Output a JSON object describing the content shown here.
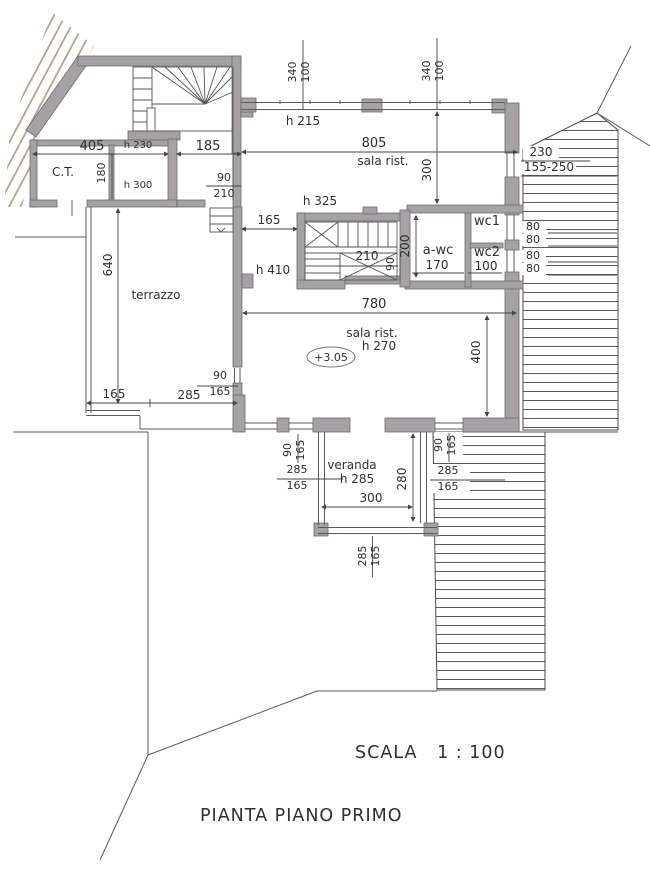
{
  "drawing": {
    "title": "PIANTA PIANO PRIMO",
    "scale_label": "SCALA   1 : 100"
  },
  "colors": {
    "wall": "#a5a1a5",
    "wall_stroke": "#6e6a6e",
    "line": "#4a4a4a",
    "terrain_hatch": "#ab9a7d",
    "text": "#2f2f2f",
    "background": "#ffffff"
  },
  "annotations": [
    {
      "name": "dim-340-left",
      "text": "340",
      "x": 296,
      "y": 72,
      "fs": 11,
      "r": -90
    },
    {
      "name": "dim-100-left",
      "text": "100",
      "x": 309,
      "y": 72,
      "fs": 11,
      "r": -90
    },
    {
      "name": "dim-340-right",
      "text": "340",
      "x": 430,
      "y": 71,
      "fs": 11,
      "r": -90
    },
    {
      "name": "dim-100-right",
      "text": "100",
      "x": 443,
      "y": 71,
      "fs": 11,
      "r": -90
    },
    {
      "name": "height-h215",
      "text": "h 215",
      "x": 303,
      "y": 125,
      "fs": 12
    },
    {
      "name": "dim-805",
      "text": "805",
      "x": 374,
      "y": 147,
      "fs": 13
    },
    {
      "name": "room-sala-rist-north",
      "text": "sala rist.",
      "x": 383,
      "y": 165,
      "fs": 12
    },
    {
      "name": "dim-300-vert",
      "text": "300",
      "x": 431,
      "y": 170,
      "fs": 12,
      "r": -90
    },
    {
      "name": "dim-230",
      "text": "230",
      "x": 541,
      "y": 156,
      "fs": 12
    },
    {
      "name": "dim-155-250",
      "text": "155-250",
      "x": 549,
      "y": 171,
      "fs": 12
    },
    {
      "name": "dim-405",
      "text": "405",
      "x": 92,
      "y": 150,
      "fs": 13
    },
    {
      "name": "height-h230",
      "text": "h 230",
      "x": 138,
      "y": 148,
      "fs": 10
    },
    {
      "name": "dim-185",
      "text": "185",
      "x": 208,
      "y": 150,
      "fs": 13
    },
    {
      "name": "room-ct",
      "text": "C.T.",
      "x": 63,
      "y": 176,
      "fs": 12
    },
    {
      "name": "dim-180",
      "text": "180",
      "x": 105,
      "y": 173,
      "fs": 11,
      "r": -90
    },
    {
      "name": "height-h300",
      "text": "h 300",
      "x": 138,
      "y": 188,
      "fs": 10
    },
    {
      "name": "dim-90-210-num",
      "text": "90",
      "x": 224,
      "y": 181,
      "fs": 11
    },
    {
      "name": "dim-90-210-den",
      "text": "210",
      "x": 224,
      "y": 197,
      "fs": 11
    },
    {
      "name": "dim-165-stair",
      "text": "165",
      "x": 269,
      "y": 224,
      "fs": 12
    },
    {
      "name": "height-h325",
      "text": "h 325",
      "x": 320,
      "y": 205,
      "fs": 12
    },
    {
      "name": "height-h410",
      "text": "h 410",
      "x": 273,
      "y": 274,
      "fs": 12
    },
    {
      "name": "dim-210-stair",
      "text": "210",
      "x": 367,
      "y": 260,
      "fs": 12
    },
    {
      "name": "dim-90-stair",
      "text": "90",
      "x": 394,
      "y": 264,
      "fs": 11,
      "r": -90
    },
    {
      "name": "dim-200-awc",
      "text": "200",
      "x": 409,
      "y": 246,
      "fs": 12,
      "r": -90
    },
    {
      "name": "room-awc",
      "text": "a-wc",
      "x": 438,
      "y": 254,
      "fs": 13
    },
    {
      "name": "dim-170-awc",
      "text": "170",
      "x": 437,
      "y": 269,
      "fs": 12
    },
    {
      "name": "room-wc1",
      "text": "wc1",
      "x": 487,
      "y": 225,
      "fs": 13
    },
    {
      "name": "room-wc2",
      "text": "wc2",
      "x": 487,
      "y": 256,
      "fs": 13
    },
    {
      "name": "dim-100-wc2",
      "text": "100",
      "x": 486,
      "y": 270,
      "fs": 12
    },
    {
      "name": "dim-80-1",
      "text": "80",
      "x": 533,
      "y": 230,
      "fs": 11
    },
    {
      "name": "dim-80-2",
      "text": "80",
      "x": 533,
      "y": 243,
      "fs": 11
    },
    {
      "name": "dim-80-3",
      "text": "80",
      "x": 533,
      "y": 259,
      "fs": 11
    },
    {
      "name": "dim-80-4",
      "text": "80",
      "x": 533,
      "y": 272,
      "fs": 11
    },
    {
      "name": "dim-780",
      "text": "780",
      "x": 374,
      "y": 308,
      "fs": 13
    },
    {
      "name": "room-sala-rist-south",
      "text": "sala rist.",
      "x": 372,
      "y": 337,
      "fs": 12
    },
    {
      "name": "height-h270",
      "text": "h 270",
      "x": 379,
      "y": 350,
      "fs": 12
    },
    {
      "name": "elevation",
      "text": "+3.05",
      "x": 331,
      "y": 361,
      "fs": 11
    },
    {
      "name": "dim-400-vert",
      "text": "400",
      "x": 480,
      "y": 352,
      "fs": 12,
      "r": -90
    },
    {
      "name": "dim-640-vert",
      "text": "640",
      "x": 112,
      "y": 265,
      "fs": 12,
      "r": -90
    },
    {
      "name": "room-terrazzo",
      "text": "terrazzo",
      "x": 156,
      "y": 299,
      "fs": 12
    },
    {
      "name": "dim-165-terrazzo",
      "text": "165",
      "x": 114,
      "y": 398,
      "fs": 12
    },
    {
      "name": "dim-285-terrazzo",
      "text": "285",
      "x": 189,
      "y": 399,
      "fs": 12
    },
    {
      "name": "dim-90-165-wall-num",
      "text": "90",
      "x": 220,
      "y": 379,
      "fs": 11
    },
    {
      "name": "dim-90-165-wall-den",
      "text": "165",
      "x": 220,
      "y": 395,
      "fs": 11
    },
    {
      "name": "dim-90-165-left-num",
      "text": "90",
      "x": 291,
      "y": 450,
      "fs": 11,
      "r": -90
    },
    {
      "name": "dim-90-165-left-den",
      "text": "165",
      "x": 304,
      "y": 450,
      "fs": 11,
      "r": -90
    },
    {
      "name": "dim-285-165-left-num",
      "text": "285",
      "x": 297,
      "y": 473,
      "fs": 11
    },
    {
      "name": "dim-285-165-left-den",
      "text": "165",
      "x": 297,
      "y": 489,
      "fs": 11
    },
    {
      "name": "room-veranda",
      "text": "veranda",
      "x": 352,
      "y": 469,
      "fs": 12
    },
    {
      "name": "height-h285",
      "text": "h 285",
      "x": 357,
      "y": 483,
      "fs": 12
    },
    {
      "name": "dim-280-vert",
      "text": "280",
      "x": 406,
      "y": 479,
      "fs": 12,
      "r": -90
    },
    {
      "name": "dim-300-veranda",
      "text": "300",
      "x": 371,
      "y": 502,
      "fs": 12
    },
    {
      "name": "dim-90-165-right-num",
      "text": "90",
      "x": 442,
      "y": 445,
      "fs": 11,
      "r": -90
    },
    {
      "name": "dim-90-165-right-den",
      "text": "165",
      "x": 455,
      "y": 445,
      "fs": 11,
      "r": -90
    },
    {
      "name": "dim-285-165-right-num",
      "text": "285",
      "x": 448,
      "y": 474,
      "fs": 11
    },
    {
      "name": "dim-285-165-right-den",
      "text": "165",
      "x": 448,
      "y": 490,
      "fs": 11
    },
    {
      "name": "dim-285-165-bottom-num",
      "text": "285",
      "x": 366,
      "y": 556,
      "fs": 11,
      "r": -90
    },
    {
      "name": "dim-285-165-bottom-den",
      "text": "165",
      "x": 379,
      "y": 556,
      "fs": 11,
      "r": -90
    }
  ]
}
